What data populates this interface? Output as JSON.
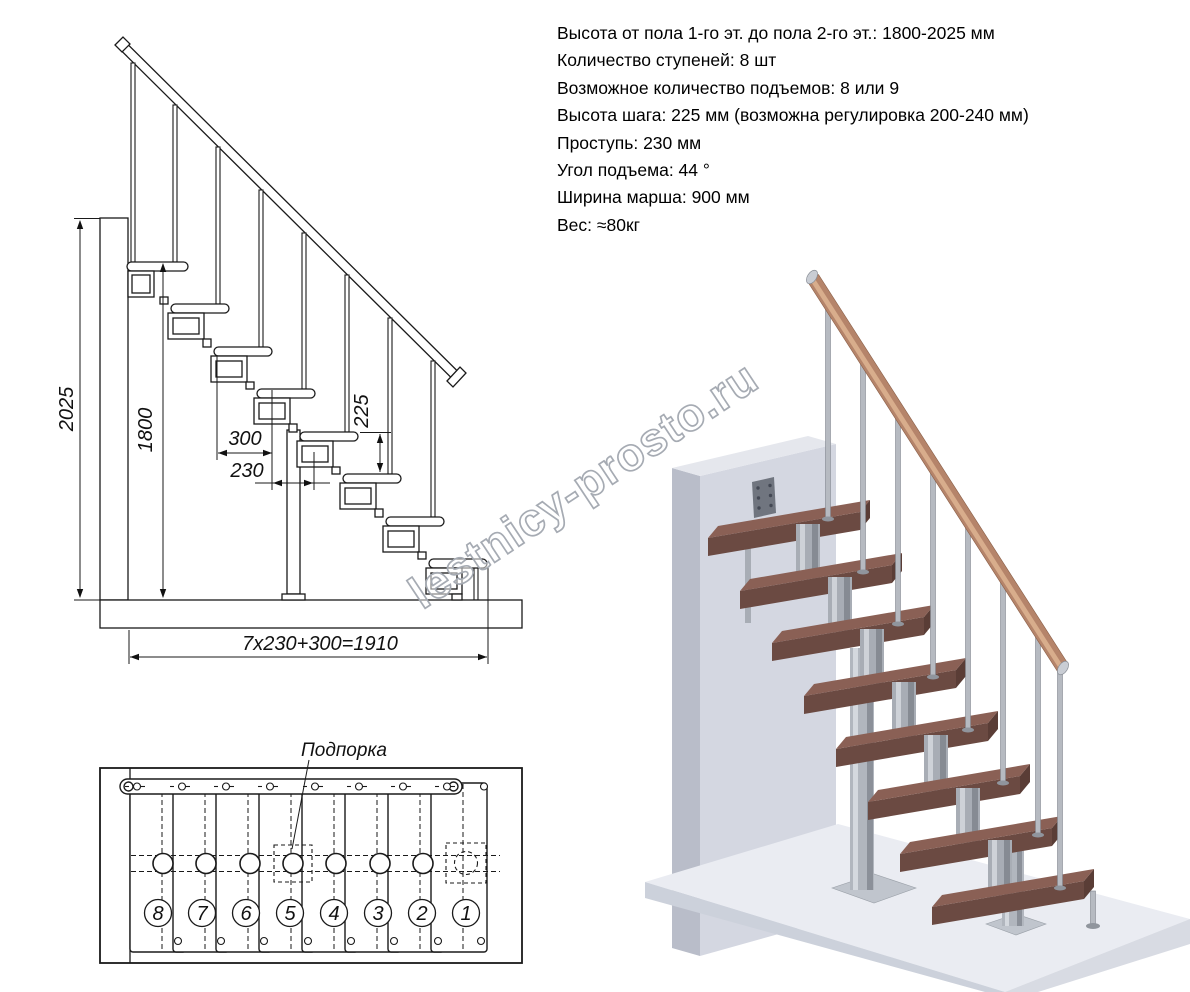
{
  "specs": {
    "items": [
      "Высота от пола 1-го эт. до пола 2-го эт.: 1800-2025 мм",
      "Количество ступеней: 8 шт",
      "Возможное количество подъемов: 8 или 9",
      "Высота шага: 225 мм (возможна регулировка 200-240 мм)",
      "Проступь: 230 мм",
      "Угол подъема: 44 °",
      "Ширина марша: 900 мм",
      "Вес: ≈80кг"
    ]
  },
  "elevation": {
    "dims": {
      "total_height": "2025",
      "rail_height": "1800",
      "tread_length": "300",
      "going": "230",
      "step_height": "225",
      "total_run": "7x230+300=1910"
    }
  },
  "plan": {
    "support_label": "Подпорка",
    "steps": [
      "8",
      "7",
      "6",
      "5",
      "4",
      "3",
      "2",
      "1"
    ]
  },
  "watermark": {
    "text": "lestnicy-prosto.ru"
  },
  "colors": {
    "line": "#1a1a1a",
    "tread_top": "#8a6055",
    "tread_front": "#6b4a42",
    "tread_side": "#5a3d36",
    "rail_wood": "#b5846a",
    "metal": "#b4b9c0",
    "wall": "#d4d7e1",
    "floor": "#eaecf2"
  }
}
